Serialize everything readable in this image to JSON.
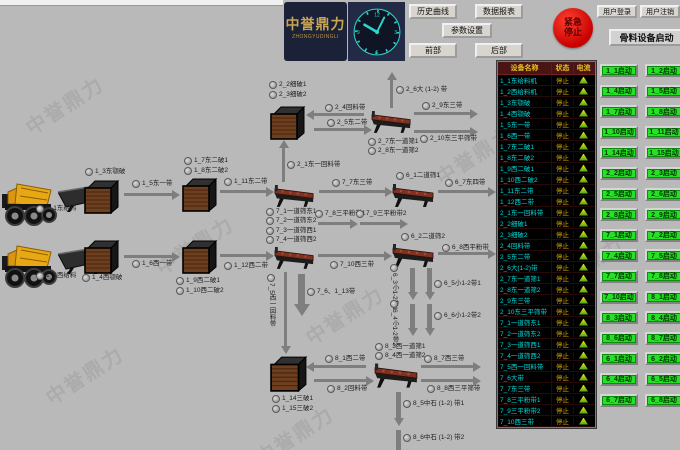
{
  "header": {
    "logo_title": "中誉鼎力",
    "logo_subtitle": "ZHONGYUDINGLI",
    "clock": {
      "n12": "12",
      "n3": "3",
      "n6": "6",
      "n9": "9"
    },
    "buttons": {
      "history": "历史曲线",
      "report": "数据报表",
      "params": "参数设置",
      "front": "前部",
      "rear": "后部"
    },
    "estop_label": "紧急停止",
    "user_login": "用户登录",
    "user_logout": "用户注销"
  },
  "right_panel": {
    "title": "骨料设备启动",
    "start_buttons": [
      "1_1启动",
      "1_2启动",
      "1_4启动",
      "1_5启动",
      "1_7启动",
      "1_8启动",
      "1_10启动",
      "1_11启动",
      "1_14启动",
      "1_15启动",
      "2_2启动",
      "2_3启动",
      "2_5启动",
      "2_6启动",
      "2_8启动",
      "2_9启动",
      "7_1启动",
      "7_2启动",
      "7_4启动",
      "7_5启动",
      "7_7启动",
      "7_8启动",
      "7_10启动",
      "8_1启动",
      "8_3启动",
      "8_4启动",
      "8_6启动",
      "8_7启动",
      "6_1启动",
      "6_2启动",
      "6_4启动",
      "6_5启动",
      "6_7启动",
      "6_8启动"
    ]
  },
  "device_table": {
    "columns": [
      "设备名称",
      "状态",
      "电流"
    ],
    "rows": [
      {
        "name": "1_1东给料机",
        "status": "停止"
      },
      {
        "name": "1_2西给料机",
        "status": "停止"
      },
      {
        "name": "1_3东颚破",
        "status": "停止"
      },
      {
        "name": "1_4西颚破",
        "status": "停止"
      },
      {
        "name": "1_5东一带",
        "status": "停止"
      },
      {
        "name": "1_6西一带",
        "status": "停止"
      },
      {
        "name": "1_7东二破1",
        "status": "停止"
      },
      {
        "name": "1_8东二破2",
        "status": "停止"
      },
      {
        "name": "1_9西二破1",
        "status": "停止"
      },
      {
        "name": "1_10西二破2",
        "status": "停止"
      },
      {
        "name": "1_11东二带",
        "status": "停止"
      },
      {
        "name": "1_12西二带",
        "status": "停止"
      },
      {
        "name": "2_1东一回料带",
        "status": "停止"
      },
      {
        "name": "2_2细破1",
        "status": "停止"
      },
      {
        "name": "2_3细破2",
        "status": "停止"
      },
      {
        "name": "2_4回料带",
        "status": "停止"
      },
      {
        "name": "2_5东二带",
        "status": "停止"
      },
      {
        "name": "2_6大(1-2)带",
        "status": "停止"
      },
      {
        "name": "2_7东一道筛1",
        "status": "停止"
      },
      {
        "name": "2_8东一道筛2",
        "status": "停止"
      },
      {
        "name": "2_9东三带",
        "status": "停止"
      },
      {
        "name": "2_10东三平筛带",
        "status": "停止"
      },
      {
        "name": "7_1一道筛东1",
        "status": "停止"
      },
      {
        "name": "7_2一道筛东2",
        "status": "停止"
      },
      {
        "name": "7_3一道筛西1",
        "status": "停止"
      },
      {
        "name": "7_4一道筛西2",
        "status": "停止"
      },
      {
        "name": "7_5西一回料带",
        "status": "停止"
      },
      {
        "name": "7_6大带",
        "status": "停止"
      },
      {
        "name": "7_7东三带",
        "status": "停止"
      },
      {
        "name": "7_8三平粉带1",
        "status": "停止"
      },
      {
        "name": "7_9三平粉带2",
        "status": "停止"
      },
      {
        "name": "7_10西三带",
        "status": "停止"
      }
    ]
  },
  "diagram": {
    "labels": [
      "1_1东给料",
      "1_3东颚破",
      "1_5东一带",
      "1_2西给料",
      "1_4西颚破",
      "1_6西一带",
      "1_7东二破1",
      "1_8东二破2",
      "1_11东二带",
      "7_1一道筛东1",
      "7_2一道筛东2",
      "2_1东一回料带",
      "2_2细破1",
      "2_3细破2",
      "2_4回料带",
      "2_5东二带",
      "2_6大 (1-2) 带",
      "2_7东一道筛1",
      "2_8东一道筛2",
      "2_9东三带",
      "2_10东三平筛带",
      "1_9西二破1",
      "1_10西二破2",
      "1_12西二带",
      "7_3一道筛西1",
      "7_4一道筛西2",
      "7_7东三带",
      "7_8三平粉带1",
      "7_9三平粉带2",
      "6_1二道筛1",
      "6_7东四带",
      "7_10西三带",
      "6_2二道筛2",
      "6_8西平粉带",
      "7_5西一回料带",
      "7_6、1_13带",
      "6_3小1-2带1",
      "6_5小1-2带1",
      "6_4小1-2带2",
      "6_6小1-2带2",
      "8_3西一道筛1",
      "8_4西一道筛2",
      "8_1西二带",
      "8_2回料带",
      "8_7西三带",
      "8_8西三平筛带",
      "1_14三破1",
      "1_15三破2",
      "8_5中石 (1-2) 带1",
      "8_6中石 (1-2) 带2"
    ]
  },
  "watermark": {
    "text": "中誉鼎力"
  }
}
